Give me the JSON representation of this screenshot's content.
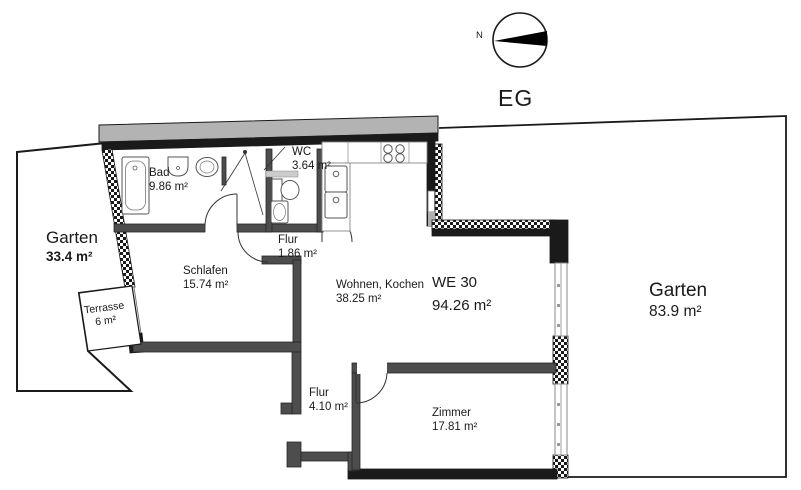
{
  "floor_label": "EG",
  "compass": {
    "north_label": "N"
  },
  "unit": {
    "name": "WE 30",
    "area": "94.26 m²"
  },
  "rooms": [
    {
      "id": "bad",
      "name": "Bad",
      "area": "9.86 m²"
    },
    {
      "id": "wc",
      "name": "WC",
      "area": "3.64 m²"
    },
    {
      "id": "flur1",
      "name": "Flur",
      "area": "1.86 m²"
    },
    {
      "id": "schlafen",
      "name": "Schlafen",
      "area": "15.74 m²"
    },
    {
      "id": "wohnen",
      "name": "Wohnen, Kochen",
      "area": "38.25 m²"
    },
    {
      "id": "flur2",
      "name": "Flur",
      "area": "4.10 m²"
    },
    {
      "id": "zimmer",
      "name": "Zimmer",
      "area": "17.81 m²"
    }
  ],
  "outdoor": [
    {
      "id": "garten-left",
      "name": "Garten",
      "area": "33.4 m²"
    },
    {
      "id": "terrasse",
      "name": "Terrasse",
      "area": "6 m²"
    },
    {
      "id": "garten-right",
      "name": "Garten",
      "area": "83.9 m²"
    }
  ],
  "colors": {
    "background": "#ffffff",
    "exterior_wall": "#1a1a1a",
    "interior_wall": "#4d4d4d",
    "neighbor_slab": "#b3b3b3",
    "fixture_stroke": "#555555"
  }
}
